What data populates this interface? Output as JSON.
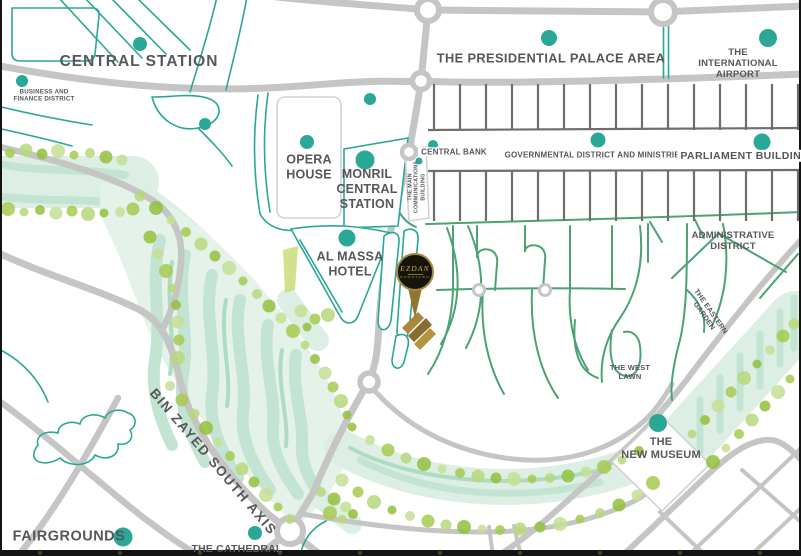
{
  "map": {
    "labels": {
      "central_station": "CENTRAL STATION",
      "business_finance": "BUSINESS AND\nFINANCE DISTRICT",
      "presidential": "THE PRESIDENTIAL PALACE AREA",
      "airport": "THE INTERNATIONAL\nAIRPORT",
      "opera": "OPERA\nHOUSE",
      "monril": "MONRIL\nCENTRAL\nSTATION",
      "communications": "THE MAIN\nCOMMUNICATIONS\nBUILDING",
      "central_bank": "CENTRAL BANK",
      "governmental": "GOVERNMENTAL DISTRICT AND MINISTRIES",
      "parliament": "PARLIAMENT BUILDING",
      "administrative": "ADMINISTRATIVE\nDISTRICT",
      "eastern_garden": "THE EASTERN\nGARDEN",
      "west_lawn": "THE WEST\nLAWN",
      "new_museum": "THE\nNEW MUSEUM",
      "bin_zayed": "BIN ZAYED SOUTH AXIS",
      "cathedral": "THE CATHEDRAL",
      "fairgrounds": "FAIRGROUNDS",
      "al_massa": "AL MASSA\nHOTEL"
    },
    "logo": {
      "brand": "EZDAN",
      "sub": "DOWNTOWN"
    },
    "colors": {
      "teal": "#2aa796",
      "road_gray": "#c5c5c5",
      "grid_gray": "#6e6e6e",
      "green_street": "#4ba272",
      "park_mint": "#ddefe4",
      "tree_lime": "#a6ca50",
      "gold": "#a8893d",
      "label_gray": "#56575a"
    }
  }
}
